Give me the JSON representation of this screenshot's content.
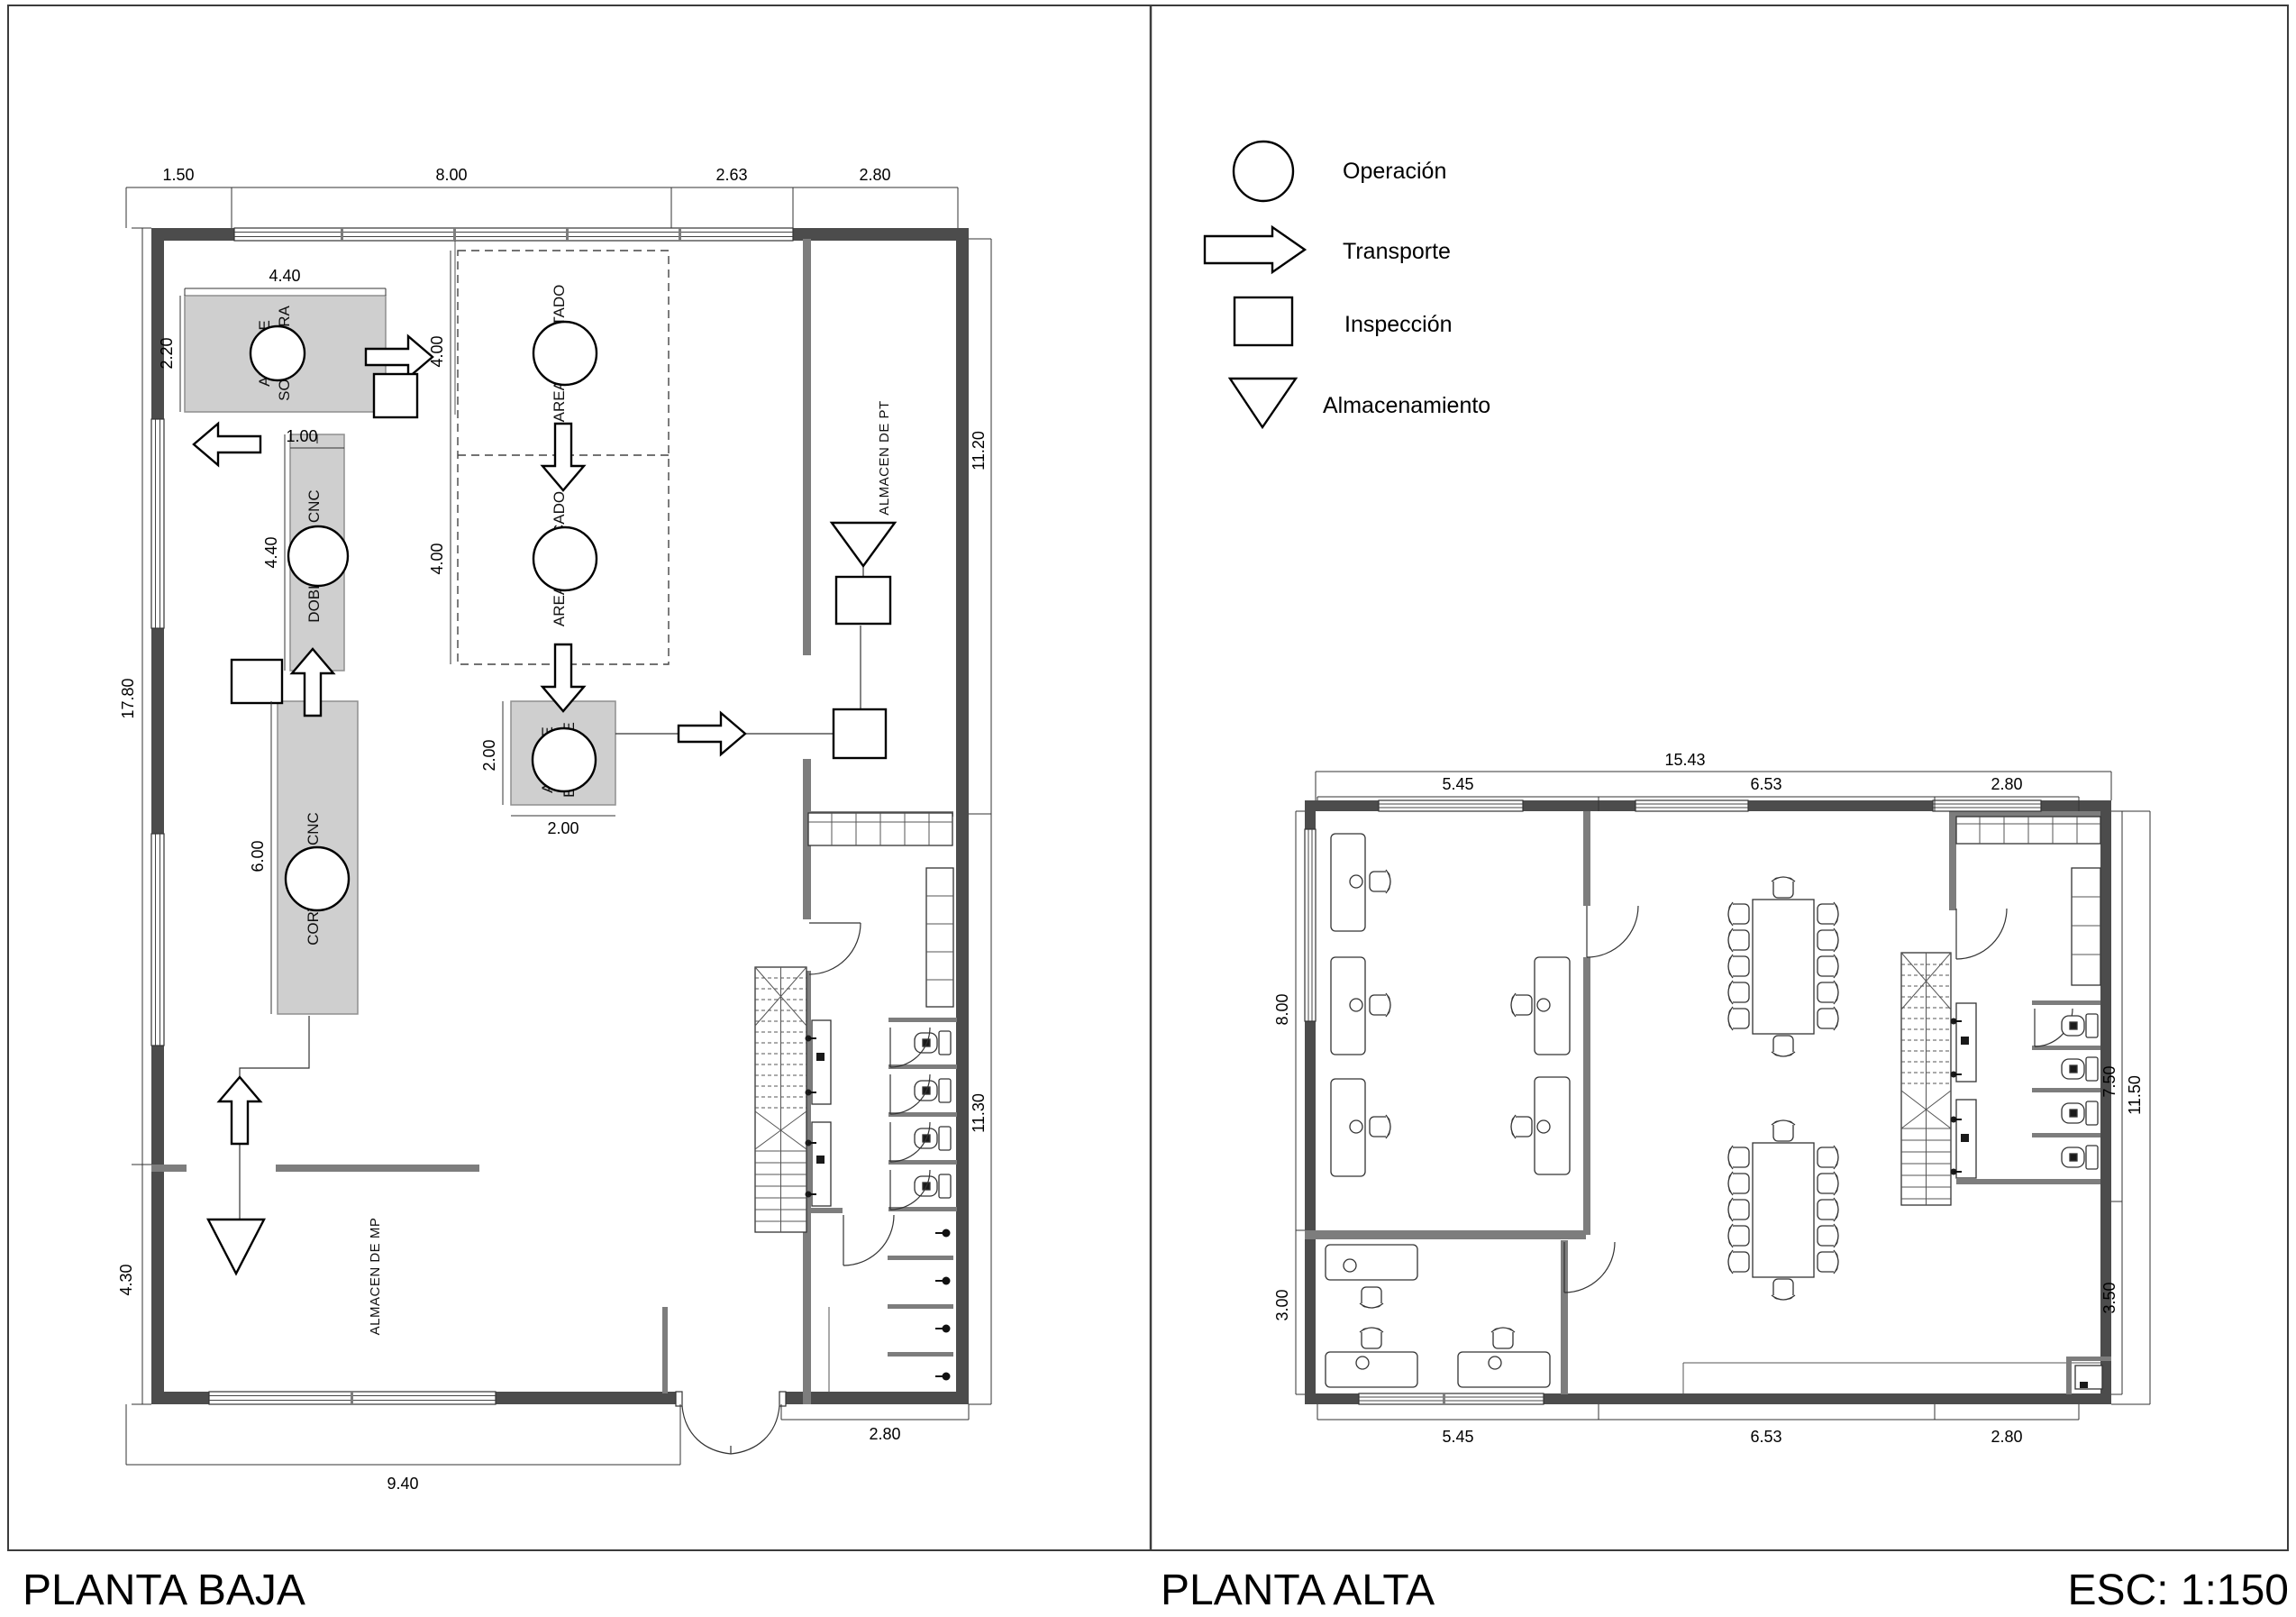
{
  "titles": {
    "left": "PLANTA BAJA",
    "right": "PLANTA ALTA",
    "scale": "ESC: 1:150"
  },
  "legend": {
    "operation": "Operación",
    "transport": "Transporte",
    "inspection": "Inspección",
    "storage": "Almacenamiento"
  },
  "planta_baja": {
    "areas": {
      "soldadura_1": "AREA DE",
      "soldadura_2": "SOLDADURA",
      "dobladora": "DOBLADORA CNC",
      "cortadora": "CORTADORA CNC",
      "pintado": "AREA DE PINTADO",
      "secado": "AREA DE SECADO",
      "empaque_1": "AREA DE",
      "empaque_2": "EMPAQUE",
      "almacen_pt": "ALMACEN DE PT",
      "almacen_mp": "ALMACEN DE MP"
    },
    "dims": {
      "top": [
        "1.50",
        "8.00",
        "2.63",
        "2.80"
      ],
      "left_total": "17.80",
      "left_mp": "4.30",
      "right_top": "11.20",
      "right_bottom": "11.30",
      "bottom": [
        "9.40",
        "2.80"
      ],
      "soldadura_w": "4.40",
      "soldadura_h": "2.20",
      "dobladora_w": "1.00",
      "dobladora_h": "4.40",
      "cortadora_h": "6.00",
      "zona1": "4.00",
      "zona2": "4.00",
      "empaque_w": "2.00",
      "empaque_h": "2.00"
    }
  },
  "planta_alta": {
    "dims": {
      "top_total": "15.43",
      "top": [
        "5.45",
        "6.53",
        "2.80"
      ],
      "bottom": [
        "5.45",
        "6.53",
        "2.80"
      ],
      "left_top": "8.00",
      "left_bottom": "3.00",
      "right_inner": "7.50",
      "right_outer": "11.50",
      "right_lower": "3.50"
    }
  }
}
